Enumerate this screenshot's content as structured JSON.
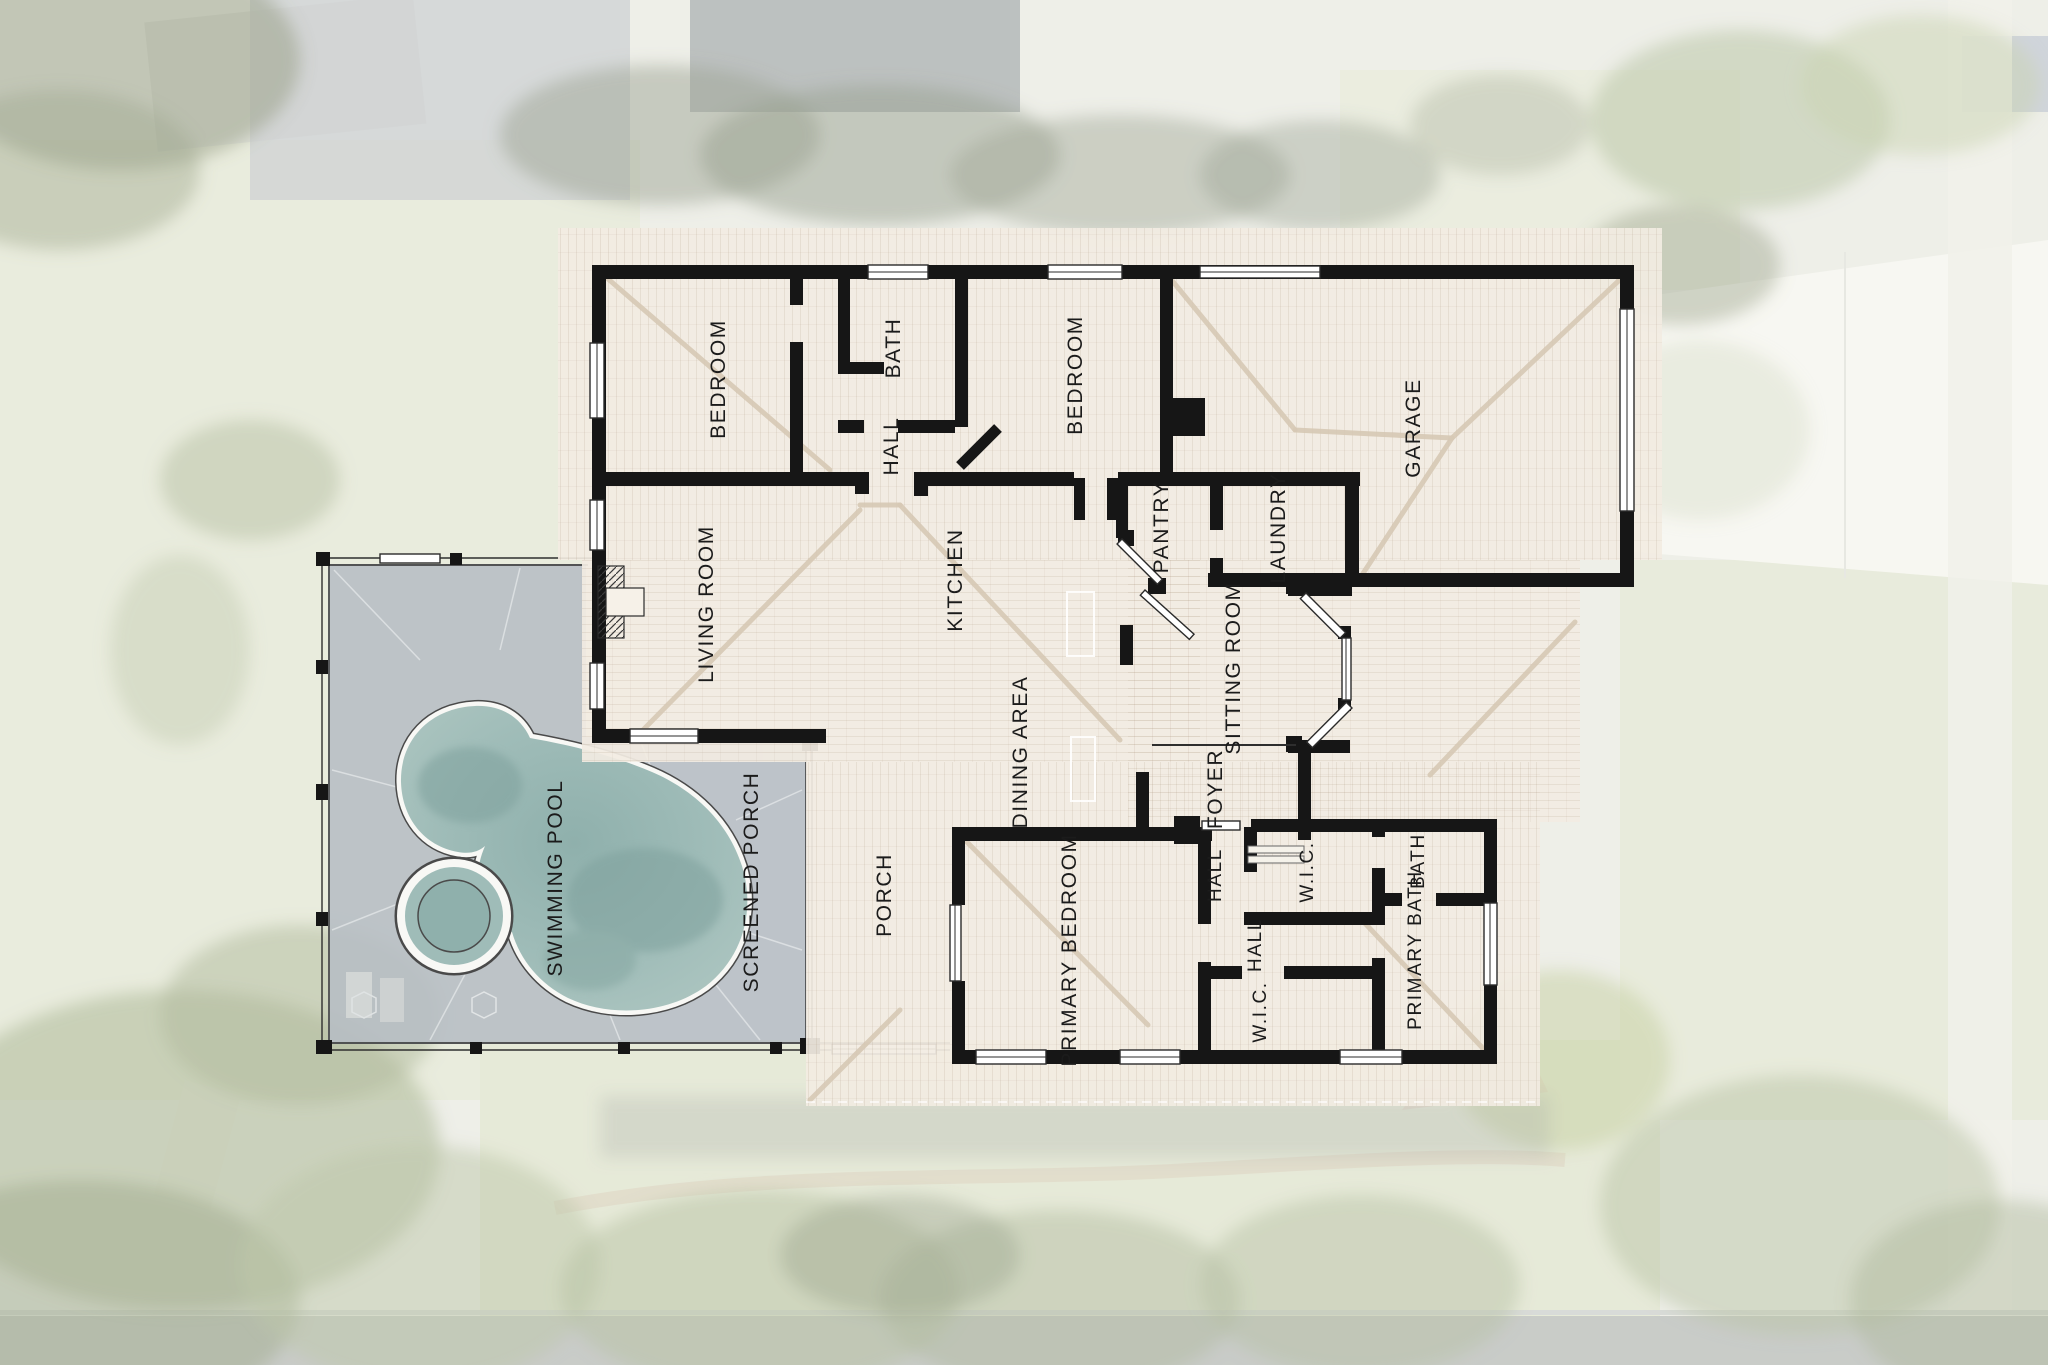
{
  "plan": {
    "type": "floor-plan-overlay-on-aerial-photo",
    "rooms": {
      "bedroom_left": "BEDROOM",
      "bath_upper": "BATH",
      "hall_upper": "HALL",
      "bedroom_mid": "BEDROOM",
      "garage": "GARAGE",
      "living_room": "LIVING ROOM",
      "kitchen": "KITCHEN",
      "pantry": "PANTRY",
      "laundry": "LAUNDRY",
      "sitting_room": "SITTING ROOM",
      "dining_area": "DINING AREA",
      "foyer": "FOYER",
      "porch": "PORCH",
      "primary_bedroom": "PRIMARY BEDROOM",
      "hall_mid": "HALL",
      "hall_lower": "HALL",
      "wic_upper": "W.I.C.",
      "bath_lower": "BATH",
      "primary_bath": "PRIMARY BATH",
      "wic_lower": "W.I.C.",
      "swimming_pool": "SWIMMING POOL",
      "screened_porch": "SCREENED PORCH"
    }
  },
  "palette": {
    "wall": "#161616",
    "roof": "#f2ece2",
    "roof_hip": "#d6c8b4",
    "pool_deck": "#b6bdc4",
    "pool_water": "#9fbcb8",
    "label_text": "#1b1b1b",
    "lawn": "#e0e4cf",
    "driveway": "#f4f4ec",
    "road": "#b2b6b1"
  }
}
